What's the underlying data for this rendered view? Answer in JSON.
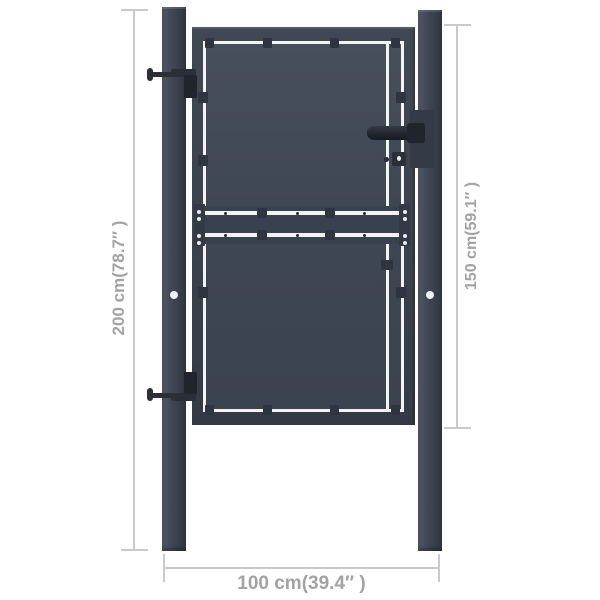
{
  "diagram": {
    "title": "steel-garden-gate-dimension-diagram",
    "dimensions": {
      "post_height": {
        "label": "200 cm(78.7″ )"
      },
      "gate_height": {
        "label": "150 cm(59.1″ )"
      },
      "total_width": {
        "label": "100 cm(39.4″ )"
      }
    },
    "colors": {
      "anthracite": "#3e4450",
      "hardware_black": "#20242c",
      "gap_line": "#f3f3f3",
      "dimension_line": "#cacaca",
      "dimension_text": "#a2a2a2",
      "background": "#ffffff"
    }
  }
}
